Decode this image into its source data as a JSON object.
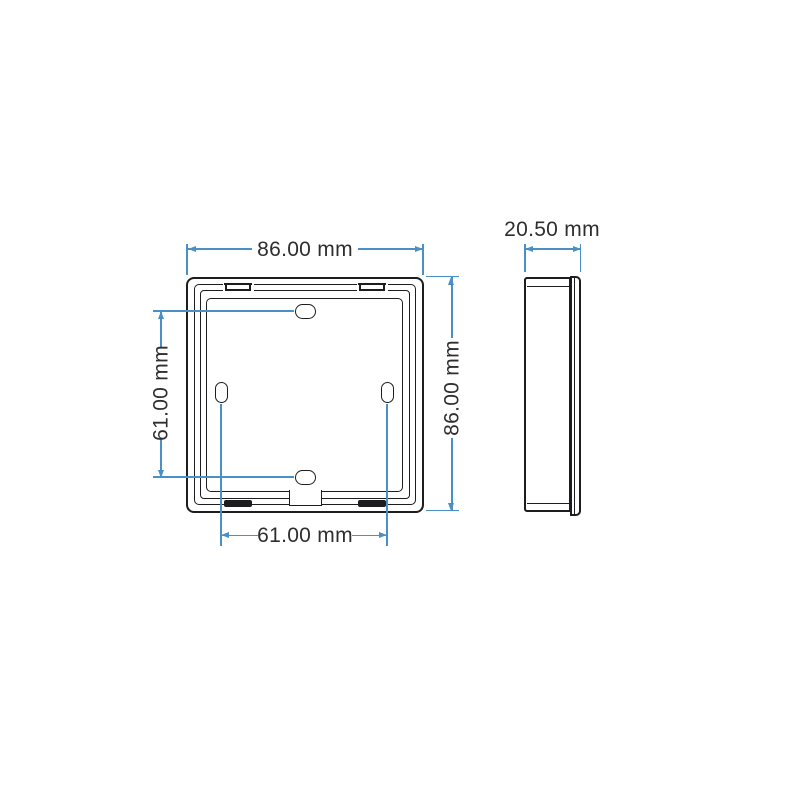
{
  "dims": {
    "front_width": "86.00 mm",
    "front_height": "86.00 mm",
    "slot_spacing_vertical": "61.00 mm",
    "slot_spacing_horizontal": "61.00 mm",
    "side_depth": "20.50 mm"
  },
  "colors": {
    "dimension_blue": "#4a90c6",
    "drawing_line_black": "#1d1d1f",
    "label_text": "#2e2e2e",
    "background": "#ffffff"
  }
}
